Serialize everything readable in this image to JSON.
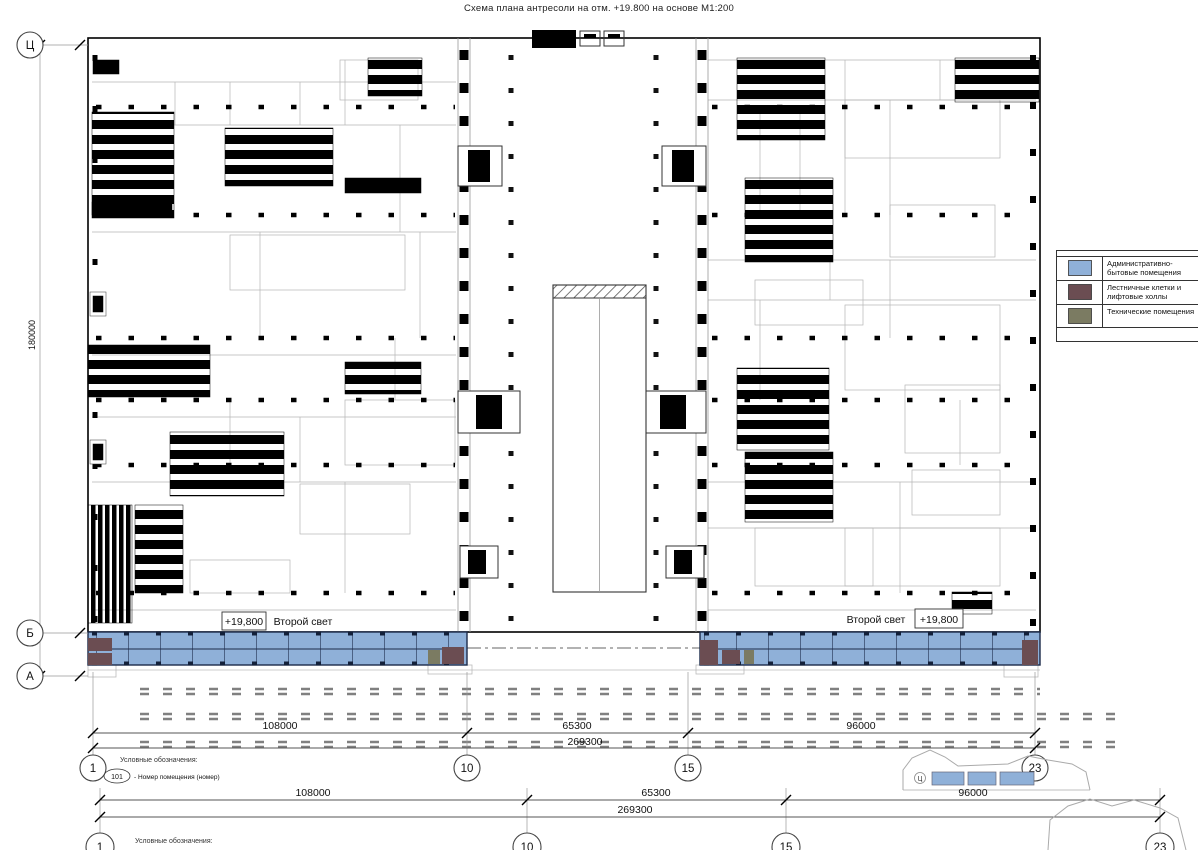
{
  "title": "Схема плана антресоли на отм. +19.800 на основе М1:200",
  "legend": {
    "items": [
      {
        "label": "Административно-бытовые помещения",
        "color": "#8FB0D8"
      },
      {
        "label": "Лестничные клетки и лифтовые холлы",
        "color": "#6B4D52"
      },
      {
        "label": "Технические помещения",
        "color": "#7B7B62"
      }
    ]
  },
  "axes": {
    "cols": [
      {
        "label": "1"
      },
      {
        "label": "10"
      },
      {
        "label": "15"
      },
      {
        "label": "23"
      }
    ],
    "rows": [
      {
        "label": "Ц"
      },
      {
        "label": "Б"
      },
      {
        "label": "А"
      }
    ]
  },
  "dimensions": {
    "segments": [
      {
        "value": "108000"
      },
      {
        "value": "65300"
      },
      {
        "value": "96000"
      }
    ],
    "total": "269300",
    "height": "180000"
  },
  "annotations": {
    "elevation": "+19,800",
    "second_light": "Второй свет"
  },
  "notes": {
    "heading": "Условные обозначения:",
    "room_tag": "101",
    "room_tag_desc": "- Номер помещения (номер)"
  },
  "colors": {
    "admin": "#8FB0D8",
    "stairs": "#6B4D52",
    "tech": "#7B7B62",
    "partition": "#1C2B4A"
  }
}
